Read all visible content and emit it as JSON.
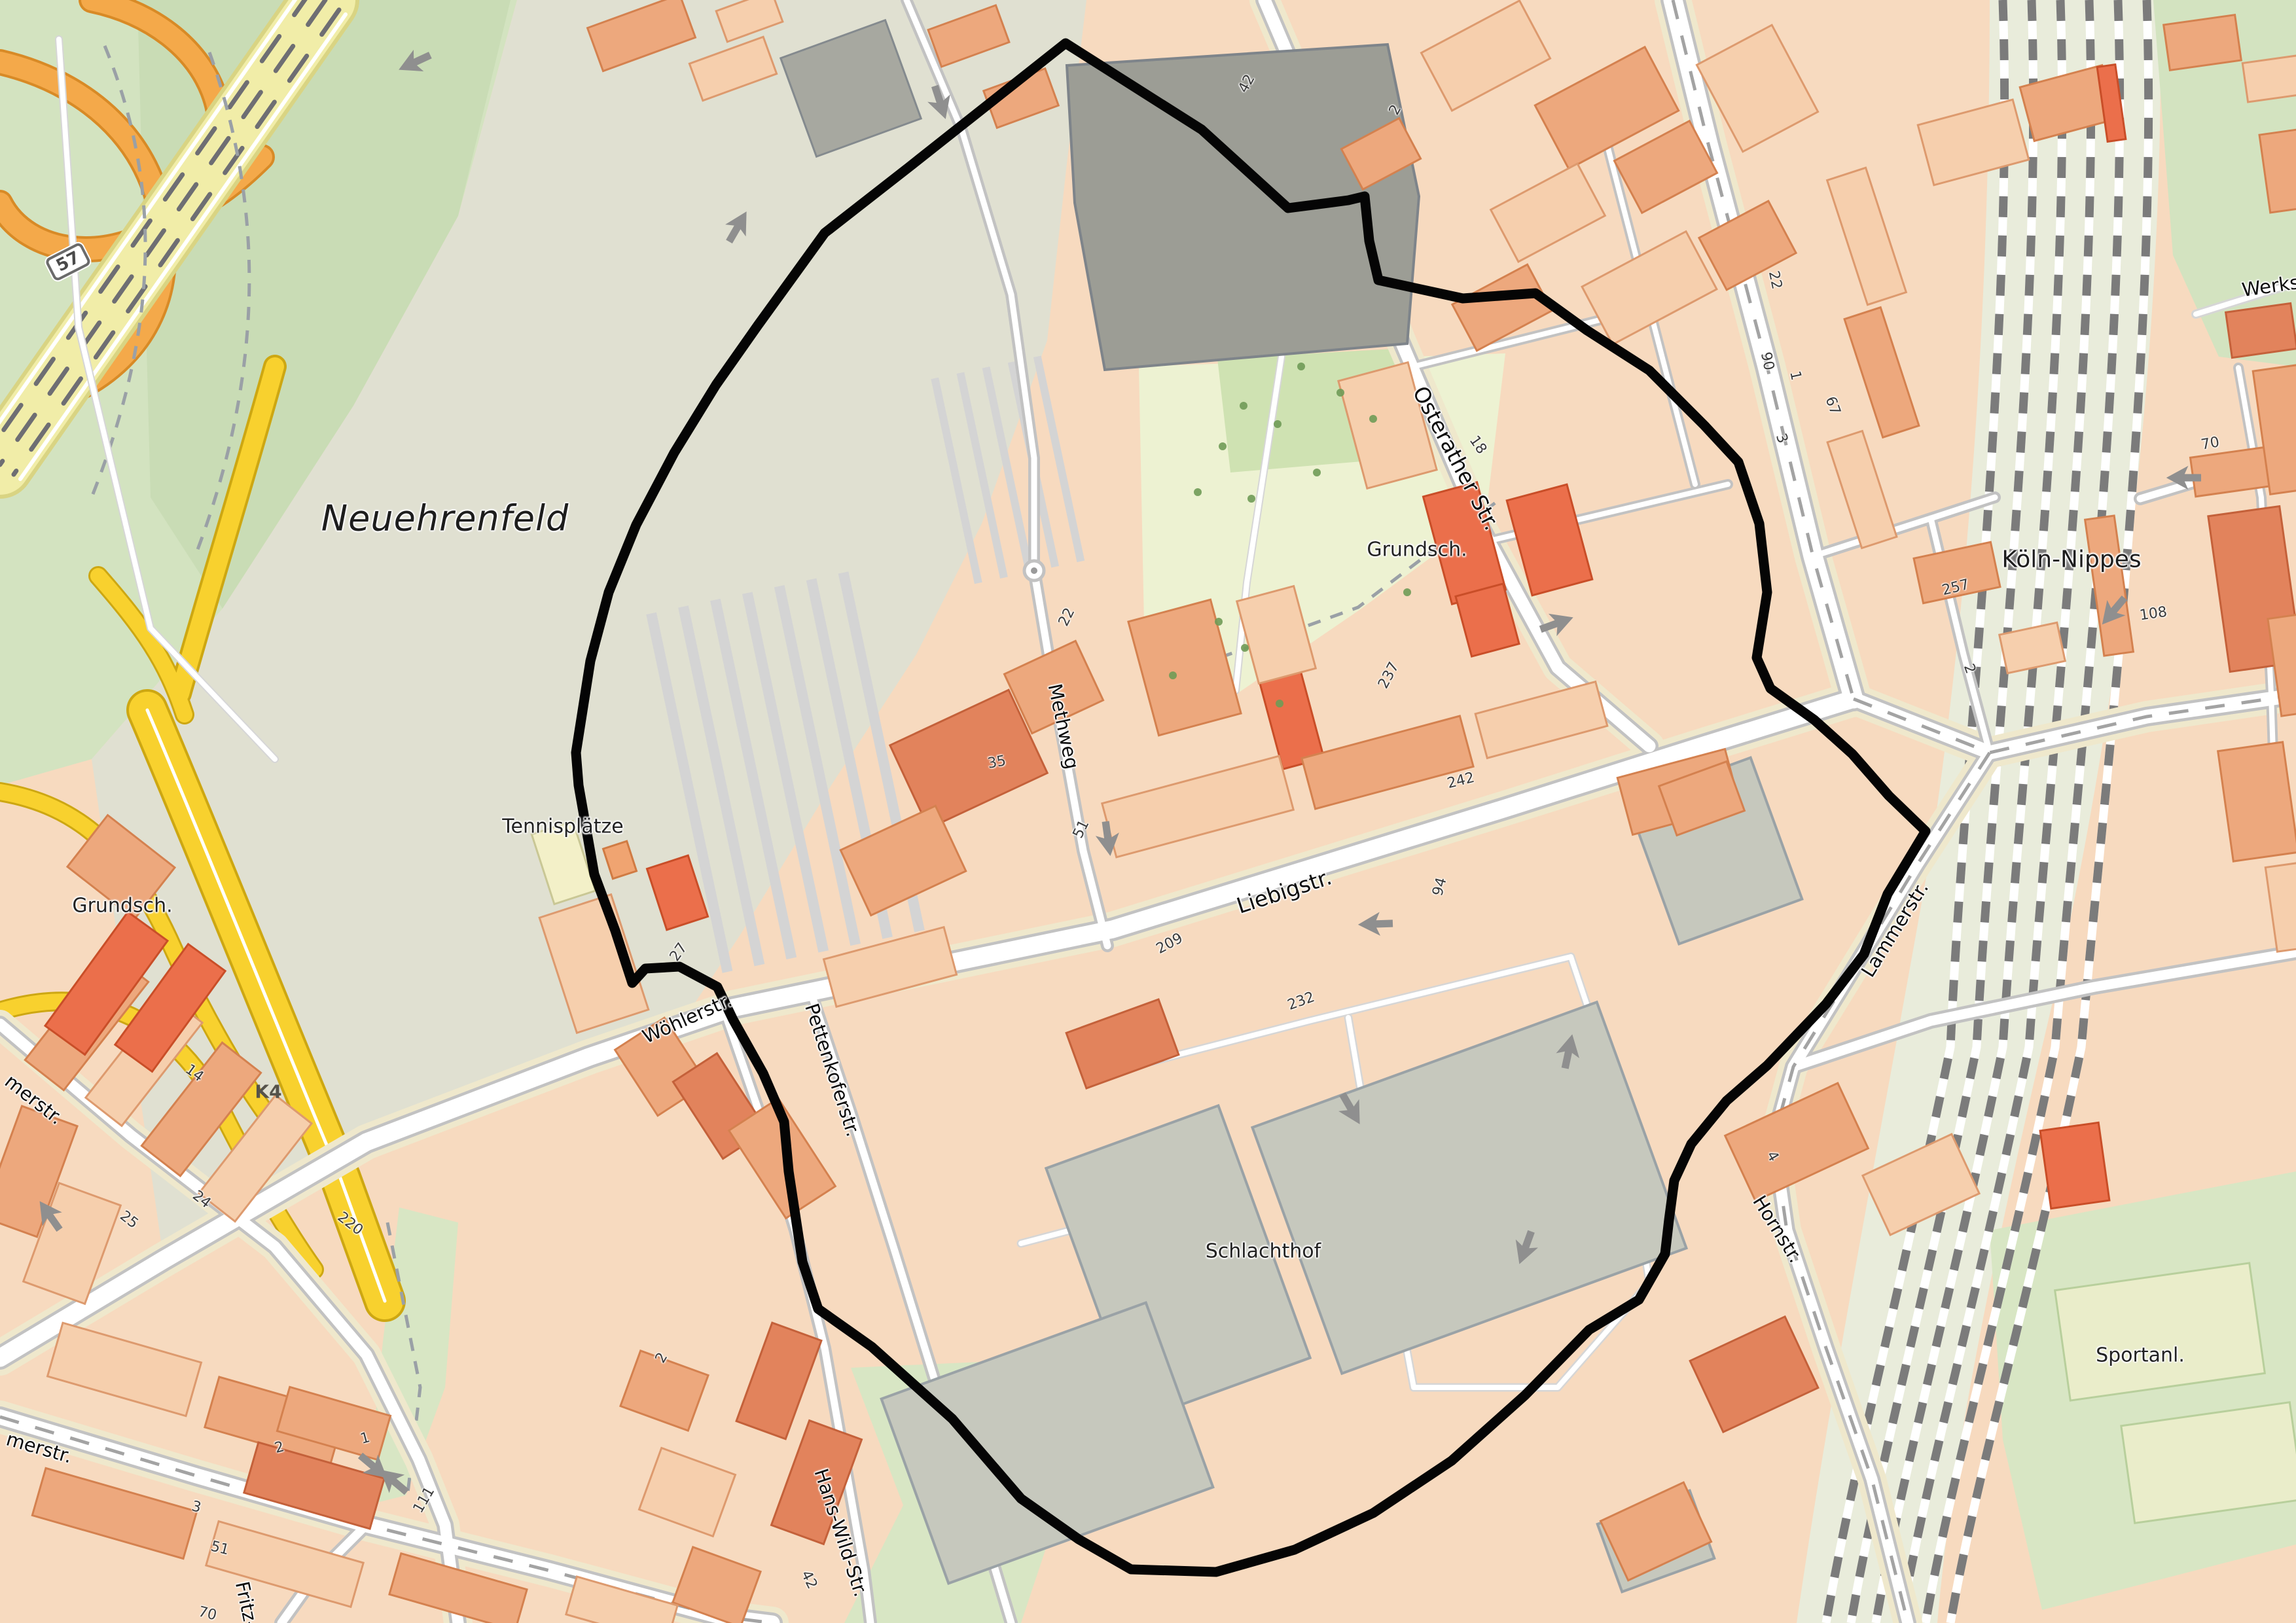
{
  "map": {
    "district_labels": [
      {
        "text": "Neuehrenfeld"
      },
      {
        "text": "Köln-Nippes"
      }
    ],
    "place_labels": [
      {
        "text": "Tennisplätze"
      },
      {
        "text": "Grundsch."
      },
      {
        "text": "Grundsch."
      },
      {
        "text": "Schlachthof"
      },
      {
        "text": "Sportanl."
      }
    ],
    "street_labels": [
      {
        "text": "Osterather Str."
      },
      {
        "text": "Methweg"
      },
      {
        "text": "Liebigstr."
      },
      {
        "text": "Wöhlerstr."
      },
      {
        "text": "Pettenkoferstr."
      },
      {
        "text": "Hans-Wild-Str."
      },
      {
        "text": "Hornstr."
      },
      {
        "text": "Lammerstr."
      },
      {
        "text": "merstr."
      },
      {
        "text": "merstr."
      },
      {
        "text": "Fritz-"
      },
      {
        "text": "Werks"
      }
    ],
    "road_refs": [
      {
        "text": "57"
      },
      {
        "text": "K4"
      }
    ],
    "house_numbers": [
      "42",
      "2",
      "18",
      "22",
      "90",
      "1",
      "67",
      "3",
      "257",
      "2",
      "70",
      "108",
      "27",
      "14",
      "220",
      "25",
      "24",
      "2",
      "1",
      "3",
      "51",
      "70",
      "111",
      "2",
      "42",
      "22",
      "35",
      "51",
      "209",
      "237",
      "242",
      "94",
      "232",
      "4"
    ],
    "colors": {
      "boundary": "#000000",
      "motorway_fill": "#f1eda8",
      "ramp_orange": "#f4a94a",
      "road_yellow": "#f8d12e",
      "park_green": "#d3e3c0",
      "building_orange": "#eda87d",
      "industrial_gray": "#9c9d95"
    }
  }
}
